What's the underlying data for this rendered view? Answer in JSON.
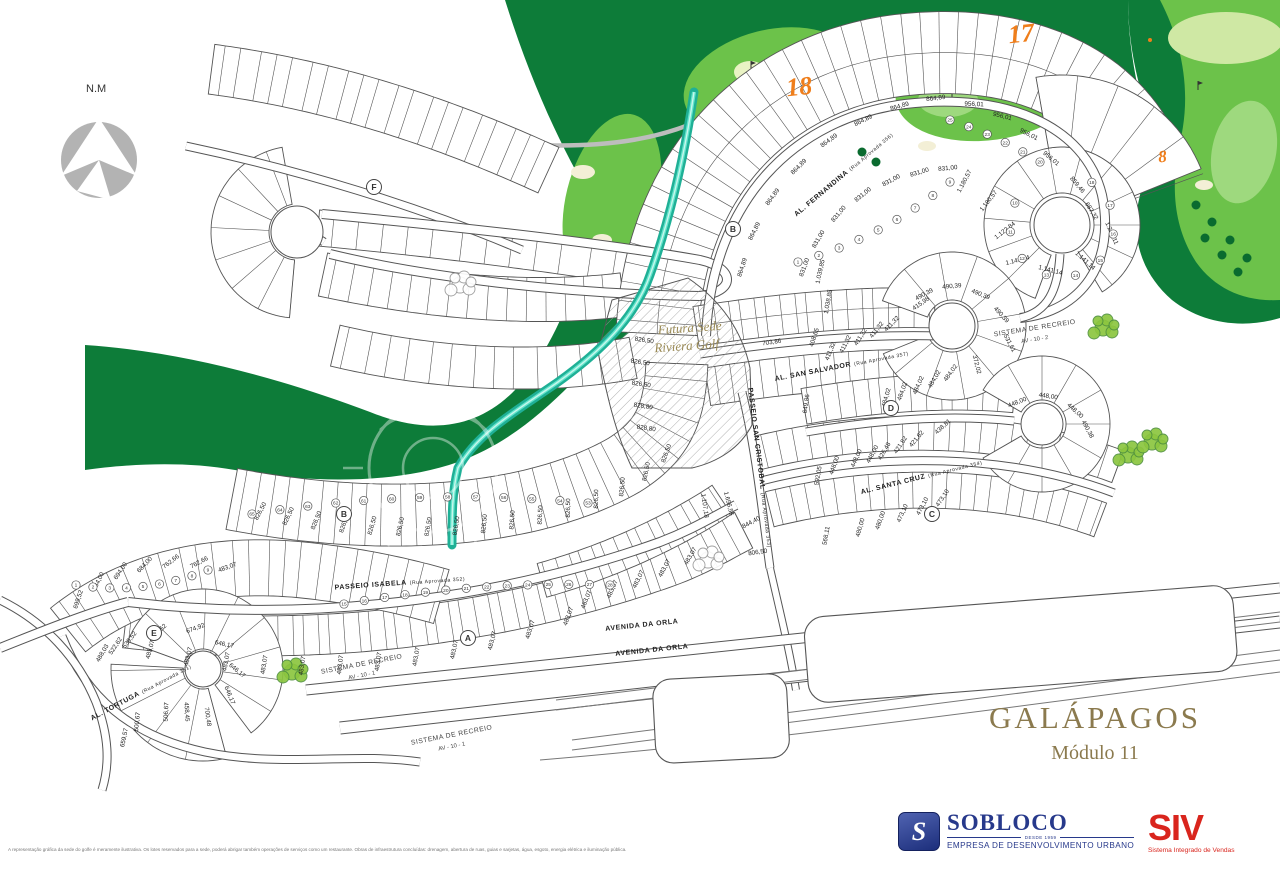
{
  "title": {
    "project": "GALÁPAGOS",
    "module": "Módulo 11"
  },
  "logos": {
    "sobloco": {
      "initial": "S",
      "name": "SOBLOCO",
      "since": "DESDE 1959",
      "tagline": "EMPRESA DE DESENVOLVIMENTO URBANO",
      "color": "#27398b"
    },
    "siv": {
      "name": "SIV",
      "tagline": "Sistema Integrado de Vendas",
      "color": "#d9251d"
    }
  },
  "footer": {
    "disclaimer": "A representação gráfica da sede do golfe é meramente ilustrativa. Os lotes reservados para a sede, poderá abrigar também operações de serviços como um restaurante. Obras de infraestrutura concluídas: drenagem, abertura de ruas, guias e sarjetas, água, esgoto, energia elétrica e iluminação pública."
  },
  "colors": {
    "golf_dark": "#0d7c39",
    "fairway": "#6cc24a",
    "fairway_light": "#9ed97e",
    "rough_pale": "#cfe8a4",
    "bunker": "#f3efd6",
    "cart_path": "#bdbdbd",
    "water": "#1fb096",
    "water_core": "#62e3cb",
    "hole_number": "#ef7e1b",
    "line": "#555555",
    "title_gold": "#8b7a4e"
  },
  "map": {
    "compass_label": "N.M",
    "future_site": {
      "line1": "Futura Sede",
      "line2": "Riviera Golf",
      "x": 690,
      "y": 332,
      "rot": -4
    },
    "golf_holes": [
      {
        "n": "18",
        "x": 800,
        "y": 95,
        "size": 26
      },
      {
        "n": "17",
        "x": 1022,
        "y": 42,
        "size": 26
      },
      {
        "n": "8",
        "x": 1163,
        "y": 162,
        "size": 17
      }
    ],
    "streets": [
      {
        "name": "AL. FERNANDINA",
        "approval": "(Rua Aprovada 356)",
        "x": 845,
        "y": 176,
        "rot": -40
      },
      {
        "name": "AL. SAN SALVADOR",
        "approval": "(Rua Aprovada 357)",
        "x": 842,
        "y": 368,
        "rot": -11
      },
      {
        "name": "AL. SANTA CRUZ",
        "approval": "(Rua Aprovada 354)",
        "x": 922,
        "y": 479,
        "rot": -14
      },
      {
        "name": "PASSEIO SAN CRISTOBAL",
        "approval": "(Rua Aprovada 353)",
        "x": 758,
        "y": 468,
        "rot": 83
      },
      {
        "name": "PASSEIO ISABELA",
        "approval": "(Rua Aprovada 352)",
        "x": 400,
        "y": 585,
        "rot": -4
      },
      {
        "name": "AL. TORTUGA",
        "approval": "(Rua Aprovada 351)",
        "x": 142,
        "y": 694,
        "rot": -28
      },
      {
        "name": "AVENIDA DA ORLA",
        "approval": "",
        "x": 642,
        "y": 627,
        "rot": -6
      },
      {
        "name": "AVENIDA DA ORLA",
        "approval": "",
        "x": 652,
        "y": 652,
        "rot": -6
      }
    ],
    "recreation_areas": [
      {
        "line1": "SISTEMA DE RECREIO",
        "line2": "AV - 10 - 2",
        "x": 1035,
        "y": 330,
        "rot": -9
      },
      {
        "line1": "SISTEMA DE RECREIO",
        "line2": "AV - 10 - 1",
        "x": 362,
        "y": 666,
        "rot": -11
      },
      {
        "line1": "SISTEMA DE RECREIO",
        "line2": "AV - 10 - 1",
        "x": 452,
        "y": 737,
        "rot": -11
      }
    ],
    "blocks": [
      {
        "letter": "F",
        "x": 374,
        "y": 187
      },
      {
        "letter": "B",
        "x": 733,
        "y": 229
      },
      {
        "letter": "B",
        "x": 344,
        "y": 514
      },
      {
        "letter": "A",
        "x": 468,
        "y": 638
      },
      {
        "letter": "C",
        "x": 932,
        "y": 514
      },
      {
        "letter": "D",
        "x": 891,
        "y": 408
      },
      {
        "letter": "E",
        "x": 154,
        "y": 633
      }
    ],
    "lot_areas": [
      [
        "864,89",
        744,
        268,
        -72
      ],
      [
        "864,89",
        756,
        232,
        -63
      ],
      [
        "864,89",
        774,
        198,
        -54
      ],
      [
        "864,89",
        800,
        168,
        -45
      ],
      [
        "864,89",
        830,
        142,
        -36
      ],
      [
        "864,89",
        864,
        122,
        -26
      ],
      [
        "864,89",
        900,
        108,
        -16
      ],
      [
        "864,89",
        936,
        100,
        -7
      ],
      [
        "831,00",
        806,
        268,
        -70
      ],
      [
        "831,00",
        820,
        240,
        -60
      ],
      [
        "831,00",
        840,
        215,
        -50
      ],
      [
        "831,00",
        864,
        196,
        -39
      ],
      [
        "831,00",
        892,
        182,
        -28
      ],
      [
        "831,00",
        920,
        174,
        -17
      ],
      [
        "831,00",
        948,
        170,
        -6
      ],
      [
        "956,01",
        974,
        106,
        2
      ],
      [
        "956,01",
        1002,
        118,
        14
      ],
      [
        "956,01",
        1028,
        136,
        27
      ],
      [
        "956,01",
        1050,
        160,
        40
      ],
      [
        "859,46",
        1076,
        186,
        50
      ],
      [
        "687,32",
        1090,
        212,
        58
      ],
      [
        "1.180,57",
        966,
        182,
        -62
      ],
      [
        "1.180,57",
        990,
        202,
        -52
      ],
      [
        "1.122,84",
        1006,
        232,
        -38
      ],
      [
        "1.141,14",
        1018,
        262,
        -14
      ],
      [
        "1.141,14",
        1050,
        272,
        14
      ],
      [
        "1.141,14",
        1084,
        262,
        42
      ],
      [
        "1.237,11",
        1110,
        234,
        66
      ],
      [
        "1.039,85",
        822,
        272,
        -78
      ],
      [
        "1.038,85",
        830,
        302,
        -80
      ],
      [
        "703,86",
        772,
        344,
        -8
      ],
      [
        "408,65",
        816,
        338,
        -72
      ],
      [
        "411,32",
        832,
        352,
        -68
      ],
      [
        "411,32",
        847,
        345,
        -63
      ],
      [
        "411,32",
        862,
        338,
        -58
      ],
      [
        "411,32",
        878,
        331,
        -52
      ],
      [
        "411,32",
        893,
        325,
        -46
      ],
      [
        "415,98",
        922,
        305,
        -35
      ],
      [
        "490,39",
        925,
        296,
        -28
      ],
      [
        "490,39",
        952,
        288,
        -5
      ],
      [
        "490,39",
        980,
        296,
        22
      ],
      [
        "490,39",
        1000,
        316,
        48
      ],
      [
        "531,61",
        1008,
        344,
        62
      ],
      [
        "372,02",
        975,
        365,
        76
      ],
      [
        "484,02",
        888,
        398,
        -74
      ],
      [
        "484,02",
        904,
        392,
        -70
      ],
      [
        "484,02",
        920,
        386,
        -66
      ],
      [
        "484,02",
        936,
        380,
        -60
      ],
      [
        "484,02",
        952,
        374,
        -54
      ],
      [
        "649,86",
        808,
        404,
        -82
      ],
      [
        "448,00",
        836,
        466,
        -70
      ],
      [
        "448,00",
        858,
        459,
        -66
      ],
      [
        "448,00",
        874,
        455,
        -62
      ],
      [
        "448,00",
        1018,
        404,
        -22
      ],
      [
        "448,00",
        1048,
        398,
        8
      ],
      [
        "448,00",
        1074,
        412,
        42
      ],
      [
        "490,38",
        1086,
        430,
        62
      ],
      [
        "421,82",
        902,
        446,
        -56
      ],
      [
        "421,82",
        918,
        440,
        -50
      ],
      [
        "426,48",
        886,
        452,
        -60
      ],
      [
        "438,81",
        944,
        428,
        -42
      ],
      [
        "592,05",
        820,
        476,
        -80
      ],
      [
        "568,11",
        828,
        536,
        -80
      ],
      [
        "480,00",
        862,
        528,
        -74
      ],
      [
        "480,00",
        882,
        521,
        -70
      ],
      [
        "473,10",
        904,
        514,
        -66
      ],
      [
        "473,10",
        924,
        507,
        -62
      ],
      [
        "473,10",
        944,
        499,
        -56
      ],
      [
        "1.107,18",
        703,
        506,
        82
      ],
      [
        "1.656,55",
        727,
        504,
        76
      ],
      [
        "844,40",
        752,
        524,
        -28
      ],
      [
        "806,50",
        758,
        554,
        -8
      ],
      [
        "826,50",
        262,
        512,
        -62
      ],
      [
        "826,50",
        290,
        517,
        -65
      ],
      [
        "826,50",
        318,
        521,
        -68
      ],
      [
        "826,50",
        346,
        524,
        -71
      ],
      [
        "826,50",
        374,
        526,
        -74
      ],
      [
        "826,50",
        402,
        527,
        -77
      ],
      [
        "826,50",
        430,
        527,
        -80
      ],
      [
        "826,50",
        458,
        526,
        -82
      ],
      [
        "826,50",
        486,
        524,
        -84
      ],
      [
        "826,50",
        514,
        520,
        -86
      ],
      [
        "826,50",
        542,
        515,
        -88
      ],
      [
        "826,50",
        570,
        508,
        -89
      ],
      [
        "826,50",
        598,
        499,
        -89
      ],
      [
        "826,50",
        624,
        487,
        -85
      ],
      [
        "826,50",
        648,
        472,
        -78
      ],
      [
        "826,50",
        668,
        454,
        -70
      ],
      [
        "828,80",
        646,
        430,
        8
      ],
      [
        "828,80",
        643,
        408,
        8
      ],
      [
        "826,50",
        641,
        386,
        8
      ],
      [
        "826,50",
        640,
        364,
        8
      ],
      [
        "826,50",
        644,
        342,
        8
      ],
      [
        "483,07",
        152,
        650,
        -75
      ],
      [
        "483,07",
        190,
        657,
        -77
      ],
      [
        "483,07",
        228,
        662,
        -79
      ],
      [
        "483,07",
        266,
        665,
        -81
      ],
      [
        "483,07",
        304,
        666,
        -82
      ],
      [
        "483,07",
        342,
        665,
        -83
      ],
      [
        "483,07",
        380,
        662,
        -82
      ],
      [
        "483,07",
        418,
        657,
        -80
      ],
      [
        "483,07",
        456,
        650,
        -78
      ],
      [
        "483,07",
        494,
        641,
        -76
      ],
      [
        "483,07",
        532,
        630,
        -73
      ],
      [
        "483,07",
        570,
        617,
        -70
      ],
      [
        "483,07",
        588,
        600,
        -68
      ],
      [
        "483,07",
        614,
        590,
        -66
      ],
      [
        "483,07",
        640,
        580,
        -64
      ],
      [
        "483,07",
        666,
        569,
        -62
      ],
      [
        "483,07",
        692,
        557,
        -60
      ],
      [
        "699,52",
        80,
        600,
        -72
      ],
      [
        "684,00",
        100,
        582,
        -64
      ],
      [
        "694,00",
        122,
        572,
        -56
      ],
      [
        "684,00",
        146,
        566,
        -47
      ],
      [
        "762,66",
        172,
        563,
        -38
      ],
      [
        "762,66",
        200,
        564,
        -28
      ],
      [
        "483,07",
        228,
        569,
        -20
      ],
      [
        "488,03",
        104,
        654,
        -60
      ],
      [
        "522,62",
        117,
        647,
        -56
      ],
      [
        "539,52",
        131,
        641,
        -52
      ],
      [
        "538,52",
        160,
        633,
        -44
      ],
      [
        "674,92",
        196,
        630,
        -20
      ],
      [
        "646,17",
        224,
        646,
        12
      ],
      [
        "646,17",
        236,
        672,
        40
      ],
      [
        "646,17",
        228,
        696,
        68
      ],
      [
        "700,48",
        206,
        717,
        82
      ],
      [
        "458,45",
        185,
        712,
        86
      ],
      [
        "506,67",
        168,
        712,
        -88
      ],
      [
        "500,67",
        139,
        722,
        -84
      ],
      [
        "659,57",
        126,
        738,
        -78
      ]
    ],
    "lot_number_rows": [
      {
        "seq": [
          65,
          64,
          63,
          62,
          61,
          60,
          59,
          58,
          57,
          56,
          55,
          54,
          53
        ],
        "x1": 252,
        "y1": 514,
        "x2": 588,
        "y2": 503,
        "bend": 22
      },
      {
        "seq": [
          15,
          16,
          17,
          18,
          19,
          20,
          21,
          22,
          23,
          24,
          25,
          26,
          27,
          28
        ],
        "x1": 344,
        "y1": 604,
        "x2": 610,
        "y2": 585,
        "bend": 14
      },
      {
        "seq": [
          1,
          2,
          3,
          4,
          5,
          6,
          7,
          8,
          9
        ],
        "x1": 76,
        "y1": 585,
        "x2": 208,
        "y2": 570,
        "bend": -18
      },
      {
        "seq": [
          25,
          24,
          23,
          22,
          21,
          20
        ],
        "x1": 950,
        "y1": 120,
        "x2": 1040,
        "y2": 162,
        "bend": 6
      },
      {
        "seq": [
          10,
          11,
          12,
          13,
          14,
          15,
          16,
          17,
          18
        ],
        "cx": 1062,
        "cy": 225,
        "r": 52,
        "a0": 205,
        "a1": -55
      },
      {
        "seq": [
          1,
          2,
          3,
          4,
          5,
          6,
          7,
          8,
          9
        ],
        "x1": 798,
        "y1": 262,
        "x2": 950,
        "y2": 182,
        "bend": -18
      }
    ]
  }
}
